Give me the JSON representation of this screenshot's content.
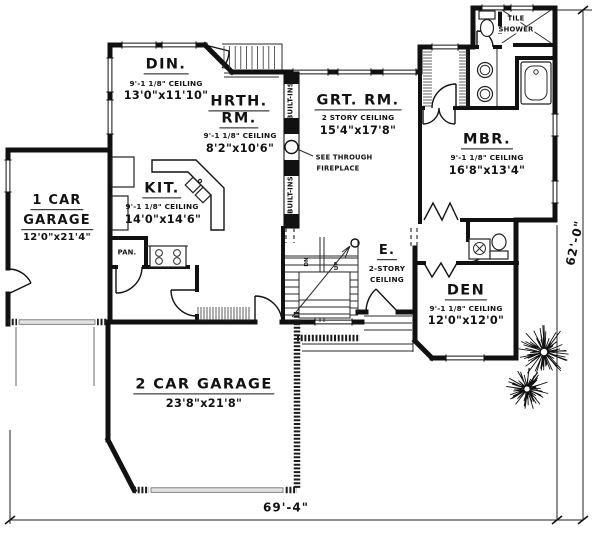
{
  "rooms": {
    "din": {
      "label": "DIN.",
      "ceiling": "9'-1 1/8\" CEILING",
      "dims": "13'0\"x11'10\""
    },
    "hrth": {
      "label": "HRTH.",
      "label2": "RM.",
      "ceiling": "9'-1 1/8\" CEILING",
      "dims": "8'2\"x10'6\""
    },
    "grt": {
      "label": "GRT. RM.",
      "ceiling": "2 STORY CEILING",
      "dims": "15'4\"x17'8\""
    },
    "mbr": {
      "label": "MBR.",
      "ceiling": "9'-1 1/8\" CEILING",
      "dims": "16'8\"x13'4\""
    },
    "kit": {
      "label": "KIT.",
      "ceiling": "9'-1 1/8\" CEILING",
      "dims": "14'0\"x14'6\""
    },
    "garage1": {
      "label": "1 CAR",
      "label2": "GARAGE",
      "dims": "12'0\"x21'4\""
    },
    "garage2": {
      "label": "2 CAR GARAGE",
      "dims": "23'8\"x21'8\""
    },
    "den": {
      "label": "DEN",
      "ceiling": "9'-1 1/8\" CEILING",
      "dims": "12'0\"x12'0\""
    },
    "entry": {
      "label": "E.",
      "ceiling": "2-STORY",
      "ceiling2": "CEILING"
    }
  },
  "annotations": {
    "fireplace_note_1": "SEE THROUGH",
    "fireplace_note_2": "FIREPLACE",
    "built_ins": "BUILT-INS",
    "pantry": "PAN.",
    "tile_shower_1": "TILE",
    "tile_shower_2": "SHOWER",
    "stair_down": "DN",
    "stair_up": "UP"
  },
  "dimensions": {
    "overall_width": "69'-4\"",
    "overall_height": "62'-0\""
  },
  "colors": {
    "ink": "#111111",
    "paper": "#ffffff"
  }
}
